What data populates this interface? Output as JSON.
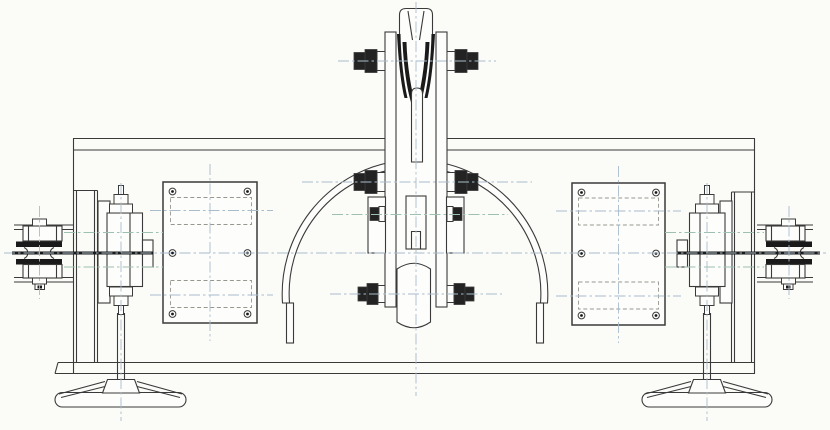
{
  "title": "Engineering line drawing, front elevation of a sheave block assembly on a beam housing with side sprockets and base feet",
  "canvas": {
    "width": 830,
    "height": 430
  },
  "colors": {
    "background": "#fbfbf8",
    "line": "#3a3a3a",
    "dark_fill": "#1a1a1a",
    "centerline": "#a9bccb",
    "centerline_alt": "#9ec0b0",
    "part_fill": "#fdfdfc"
  },
  "components": {
    "main_beam": "beam-housing",
    "left_column": "left-support-column",
    "right_column": "right-support-column",
    "left_plate": "left-cover-plate",
    "right_plate": "right-cover-plate",
    "center_block": "center-sheave-block",
    "top_lug": "top-clevis-lug",
    "roller": "bottom-barrel-roller",
    "guards": "curved-guard-bands",
    "sprockets": "edge-on-double-sprockets",
    "hubs": "bearing-hubs",
    "feet": "base-feet"
  },
  "drawing": {
    "centerlines": {
      "vertical": [
        {
          "x": 416,
          "y1": 2,
          "y2": 396
        },
        {
          "x": 121,
          "y1": 183,
          "y2": 421
        },
        {
          "x": 707,
          "y1": 183,
          "y2": 421
        },
        {
          "x": 39.5,
          "y1": 206,
          "y2": 299
        },
        {
          "x": 789,
          "y1": 206,
          "y2": 299
        },
        {
          "x": 210,
          "y1": 164,
          "y2": 341
        },
        {
          "x": 618.5,
          "y1": 166,
          "y2": 343
        }
      ],
      "horizontal": [
        {
          "y": 253,
          "x1": 4,
          "x2": 826
        },
        {
          "y": 61,
          "x1": 338,
          "x2": 496
        },
        {
          "y": 182,
          "x1": 302,
          "x2": 532
        },
        {
          "y": 294,
          "x1": 330,
          "x2": 502
        },
        {
          "y": 210.5,
          "x1": 150,
          "x2": 273
        },
        {
          "y": 295,
          "x1": 150,
          "x2": 273
        },
        {
          "y": 211,
          "x1": 556,
          "x2": 681
        },
        {
          "y": 296,
          "x1": 556,
          "x2": 681
        },
        {
          "y": 214.5,
          "x1": 332,
          "x2": 508,
          "alt": true
        },
        {
          "y": 232.5,
          "x1": 64,
          "x2": 163,
          "alt": true
        },
        {
          "y": 267,
          "x1": 64,
          "x2": 163,
          "alt": true
        },
        {
          "y": 232.5,
          "x1": 665,
          "x2": 764,
          "alt": true
        },
        {
          "y": 267,
          "x1": 665,
          "x2": 764,
          "alt": true
        }
      ]
    },
    "plate_screws": [
      {
        "cx": 172.5,
        "cy": 191.5
      },
      {
        "cx": 247.5,
        "cy": 191.5
      },
      {
        "cx": 172.5,
        "cy": 253
      },
      {
        "cx": 247.5,
        "cy": 253
      },
      {
        "cx": 172.5,
        "cy": 314
      },
      {
        "cx": 247.5,
        "cy": 314
      },
      {
        "cx": 581.5,
        "cy": 192.5
      },
      {
        "cx": 656,
        "cy": 192.5
      },
      {
        "cx": 581.5,
        "cy": 253.5
      },
      {
        "cx": 656,
        "cy": 253.5
      },
      {
        "cx": 581.5,
        "cy": 315.5
      },
      {
        "cx": 656,
        "cy": 315.5
      }
    ],
    "dashed_insets": [
      {
        "x": 170.5,
        "y": 197.5,
        "w": 81,
        "h": 27
      },
      {
        "x": 170.5,
        "y": 280.5,
        "w": 81,
        "h": 27
      },
      {
        "x": 578.5,
        "y": 198,
        "w": 80,
        "h": 27
      },
      {
        "x": 578.5,
        "y": 282,
        "w": 80,
        "h": 27
      }
    ],
    "hex_bolts": [
      {
        "x": 385,
        "y": 61,
        "o": "L",
        "s": "l"
      },
      {
        "x": 447,
        "y": 61,
        "o": "R",
        "s": "l"
      },
      {
        "x": 385,
        "y": 182,
        "o": "L",
        "s": "l"
      },
      {
        "x": 447,
        "y": 182,
        "o": "R",
        "s": "l"
      },
      {
        "x": 385,
        "y": 214,
        "o": "L",
        "s": "s"
      },
      {
        "x": 447,
        "y": 214,
        "o": "R",
        "s": "s"
      },
      {
        "x": 385,
        "y": 294,
        "o": "L",
        "s": "m"
      },
      {
        "x": 447,
        "y": 294,
        "o": "R",
        "s": "m"
      },
      {
        "x": 121,
        "y": 213,
        "o": "U"
      },
      {
        "x": 121,
        "y": 287,
        "o": "D"
      },
      {
        "x": 707,
        "y": 213,
        "o": "U"
      },
      {
        "x": 707,
        "y": 287,
        "o": "D"
      }
    ]
  }
}
